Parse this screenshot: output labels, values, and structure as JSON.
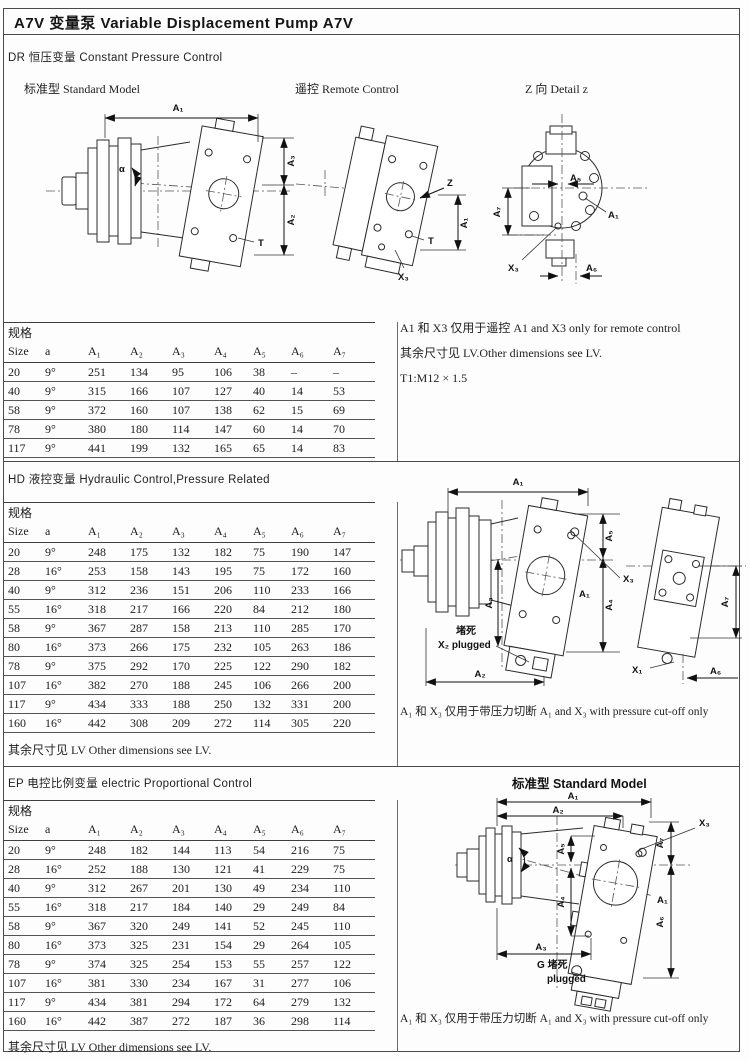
{
  "page": {
    "title": "A7V 变量泵 Variable Displacement Pump A7V"
  },
  "spec_label": "规格",
  "table_headers": [
    "Size",
    "a",
    "A₁",
    "A₂",
    "A₃",
    "A₄",
    "A₅",
    "A₆",
    "A₇"
  ],
  "labels": {
    "a1": "A₁",
    "a2": "A₂",
    "a3": "A₃",
    "a4": "A₄",
    "a5": "A₅",
    "a6": "A₆",
    "a7": "A₇",
    "alpha": "α",
    "t": "T",
    "z": "Z",
    "x1": "X₁",
    "x3": "X₃",
    "plug_cn": "堵死",
    "plug_x2": "X₂ plugged",
    "plug_g": "G 堵死",
    "plug_en": "plugged"
  },
  "sections": {
    "dr": {
      "title": "DR 恒压变量 Constant Pressure Control",
      "captions": {
        "standard": "标准型  Standard Model",
        "remote": "遥控 Remote Control",
        "detail": "Z 向 Detail z"
      },
      "notes": [
        "A1 和 X3 仅用于遥控 A1 and X3 only for remote control",
        "其余尺寸见 LV.Other dimensions see LV.",
        "T1:M12 × 1.5"
      ],
      "rows": [
        [
          "20",
          "9°",
          "251",
          "134",
          "95",
          "106",
          "38",
          "–",
          "–"
        ],
        [
          "40",
          "9°",
          "315",
          "166",
          "107",
          "127",
          "40",
          "14",
          "53"
        ],
        [
          "58",
          "9°",
          "372",
          "160",
          "107",
          "138",
          "62",
          "15",
          "69"
        ],
        [
          "78",
          "9°",
          "380",
          "180",
          "114",
          "147",
          "60",
          "14",
          "70"
        ],
        [
          "117",
          "9°",
          "441",
          "199",
          "132",
          "165",
          "65",
          "14",
          "83"
        ]
      ]
    },
    "hd": {
      "title": "HD 液控变量 Hydraulic Control,Pressure Related",
      "rows": [
        [
          "20",
          "9°",
          "248",
          "175",
          "132",
          "182",
          "75",
          "190",
          "147"
        ],
        [
          "28",
          "16°",
          "253",
          "158",
          "143",
          "195",
          "75",
          "172",
          "160"
        ],
        [
          "40",
          "9°",
          "312",
          "236",
          "151",
          "206",
          "110",
          "233",
          "166"
        ],
        [
          "55",
          "16°",
          "318",
          "217",
          "166",
          "220",
          "84",
          "212",
          "180"
        ],
        [
          "58",
          "9°",
          "367",
          "287",
          "158",
          "213",
          "110",
          "285",
          "170"
        ],
        [
          "80",
          "16°",
          "373",
          "266",
          "175",
          "232",
          "105",
          "263",
          "186"
        ],
        [
          "78",
          "9°",
          "375",
          "292",
          "170",
          "225",
          "122",
          "290",
          "182"
        ],
        [
          "107",
          "16°",
          "382",
          "270",
          "188",
          "245",
          "106",
          "266",
          "200"
        ],
        [
          "117",
          "9°",
          "434",
          "333",
          "188",
          "250",
          "132",
          "331",
          "200"
        ],
        [
          "160",
          "16°",
          "442",
          "308",
          "209",
          "272",
          "114",
          "305",
          "220"
        ]
      ],
      "note_right": "A₁ 和 X₃ 仅用于带压力切断 A₁ and X₃ with pressure cut-off only",
      "note_bottom": "其余尺寸见 LV Other dimensions see LV."
    },
    "ep": {
      "title": "EP 电控比例变量 electric Proportional Control",
      "caption": "标准型 Standard Model",
      "rows": [
        [
          "20",
          "9°",
          "248",
          "182",
          "144",
          "113",
          "54",
          "216",
          "75"
        ],
        [
          "28",
          "16°",
          "252",
          "188",
          "130",
          "121",
          "41",
          "229",
          "75"
        ],
        [
          "40",
          "9°",
          "312",
          "267",
          "201",
          "130",
          "49",
          "234",
          "110"
        ],
        [
          "55",
          "16°",
          "318",
          "217",
          "184",
          "140",
          "29",
          "249",
          "84"
        ],
        [
          "58",
          "9°",
          "367",
          "320",
          "249",
          "141",
          "52",
          "245",
          "110"
        ],
        [
          "80",
          "16°",
          "373",
          "325",
          "231",
          "154",
          "29",
          "264",
          "105"
        ],
        [
          "78",
          "9°",
          "374",
          "325",
          "254",
          "153",
          "55",
          "257",
          "122"
        ],
        [
          "107",
          "16°",
          "381",
          "330",
          "234",
          "167",
          "31",
          "277",
          "106"
        ],
        [
          "117",
          "9°",
          "434",
          "381",
          "294",
          "172",
          "64",
          "279",
          "132"
        ],
        [
          "160",
          "16°",
          "442",
          "387",
          "272",
          "187",
          "36",
          "298",
          "114"
        ]
      ],
      "note_right": "A₁ 和 X₃ 仅用于带压力切断 A₁ and X₃ with pressure cut-off only",
      "note_bottom": "其余尺寸见 LV Other dimensions see LV."
    }
  }
}
